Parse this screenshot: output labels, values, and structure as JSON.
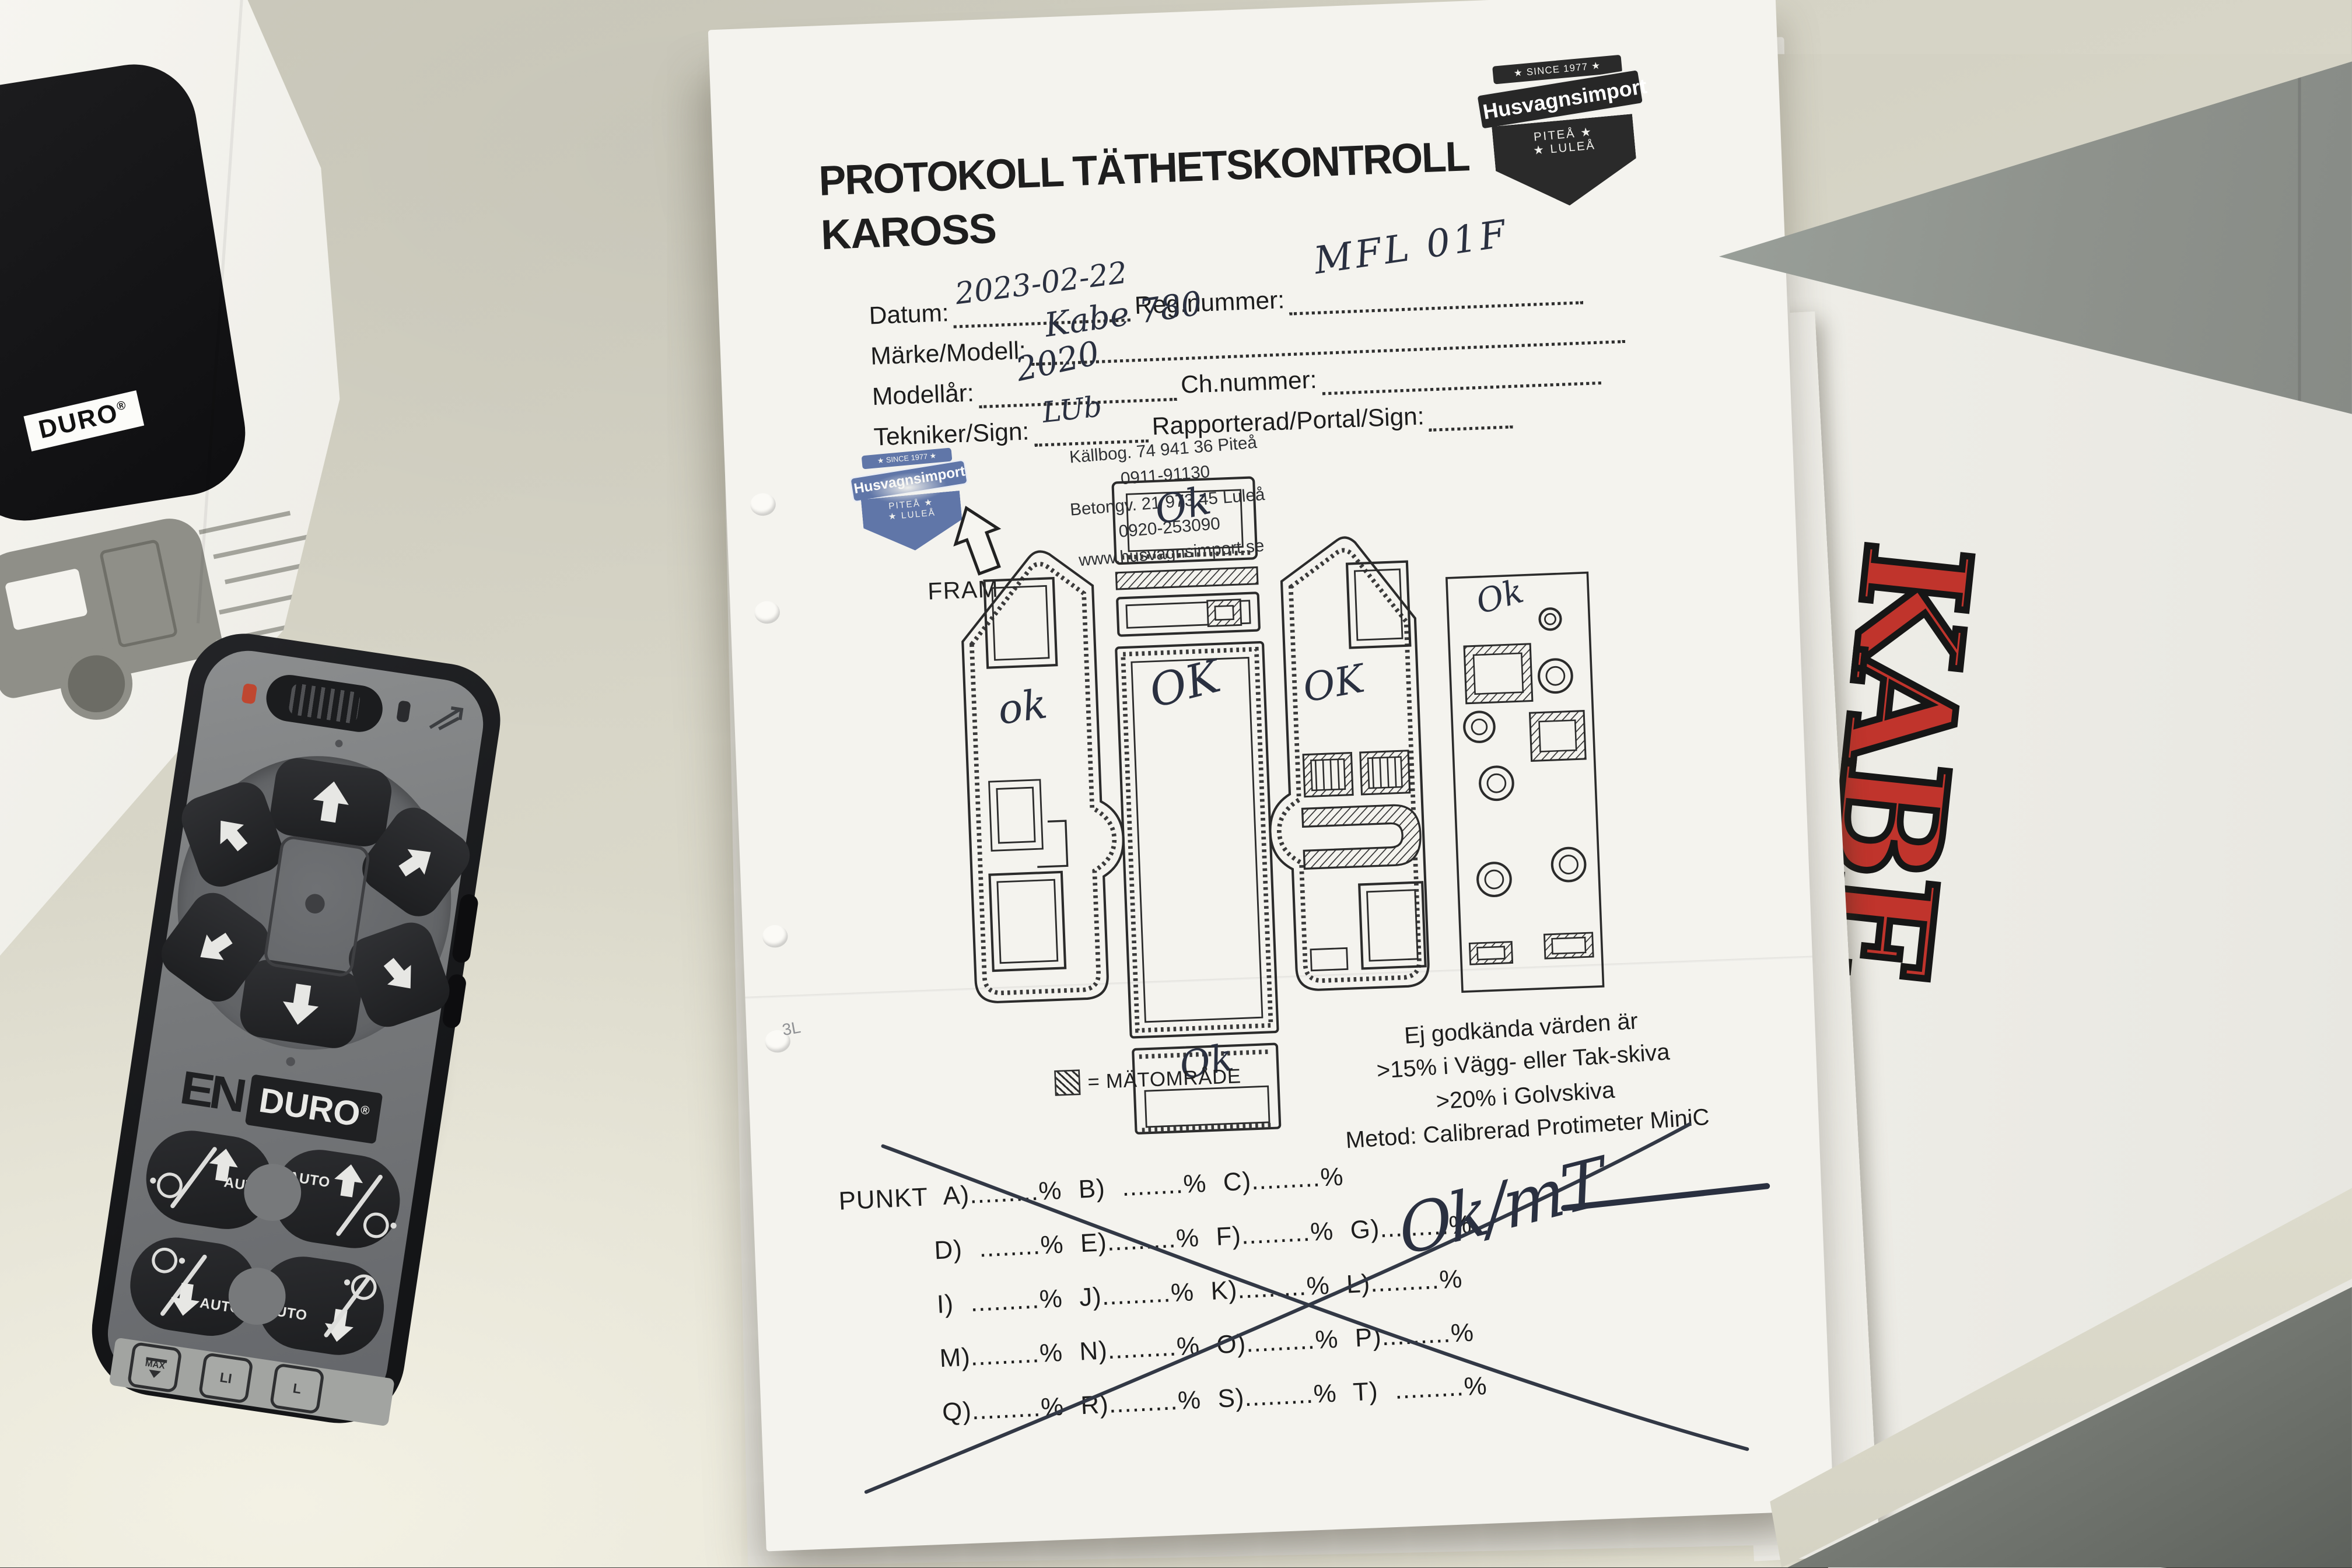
{
  "colors": {
    "ink": "#2a3040",
    "kabe_red": "#c0342c",
    "stamp_blue": "#47619c",
    "folder_grey": "#8f938d",
    "desk": "#d8d6c8"
  },
  "left_paper": {
    "duro_label": "DURO",
    "registered": "®",
    "page_number": "1"
  },
  "remote": {
    "brand_en": "EN",
    "brand_duro": "DURO",
    "registered": "®",
    "auto_label": "AUTO",
    "max_label": "MAX",
    "li_battery_label": "LI",
    "lead_battery_label": "L"
  },
  "document": {
    "title_line1": "PROTOKOLL TÄTHETSKONTROLL",
    "title_line2": "KAROSS",
    "badge": {
      "since": "★ SINCE 1977 ★",
      "name": "Husvagnsimport",
      "pitea": "PITEÅ ★",
      "lulea": "★ LULEÅ"
    },
    "stamp": {
      "since": "★ SINCE 1977 ★",
      "name": "Husvagnsimport",
      "pitea": "PITEÅ ★",
      "lulea": "★ LULEÅ"
    },
    "fields": {
      "datum_label": "Datum:",
      "datum_value": "2023-02-22",
      "reg_label": "Reg.nummer:",
      "reg_value": "MFL 01F",
      "marke_label": "Märke/Modell:",
      "marke_value": "Kabe 780",
      "modellar_label": "Modellår:",
      "modellar_value": "2020",
      "ch_label": "Ch.nummer:",
      "tekniker_label": "Tekniker/Sign:",
      "tekniker_value": "LUb",
      "rapporterad_label": "Rapporterad/Portal/Sign:"
    },
    "address": [
      "Källbog. 74 941 36 Piteå",
      "0911-91130",
      "Betongv. 21 973 45 Luleå",
      "0920-253090",
      "www.husvagnsimport.se"
    ],
    "fram_label": "FRAM",
    "diagram_marks": {
      "front": "Ok",
      "roof": "OK",
      "left_wall": "ok",
      "right_wall": "OK",
      "floor": "Ok",
      "rear": "Ok"
    },
    "legend": "= MÄTOMRÅDE",
    "notes": [
      "Ej godkända värden är",
      ">15% i Vägg- eller Tak-skiva",
      ">20% i Golvskiva",
      "Metod: Calibrerad Protimeter MiniC"
    ],
    "punkt_rows": [
      "PUNKT A).........%  B) ........%  C).........%",
      "D) ........%  E).........%  F).........%  G).........%",
      "I) .........%  J).........%  K).........%  L).........%",
      "M).........%  N).........%  O).........%  P).........%",
      "Q).........%  R).........%  S).........%  T) .........%"
    ],
    "margin_note": "3L",
    "signature": "Ok/mT"
  },
  "kabe_paper": {
    "logo": "KABE"
  }
}
